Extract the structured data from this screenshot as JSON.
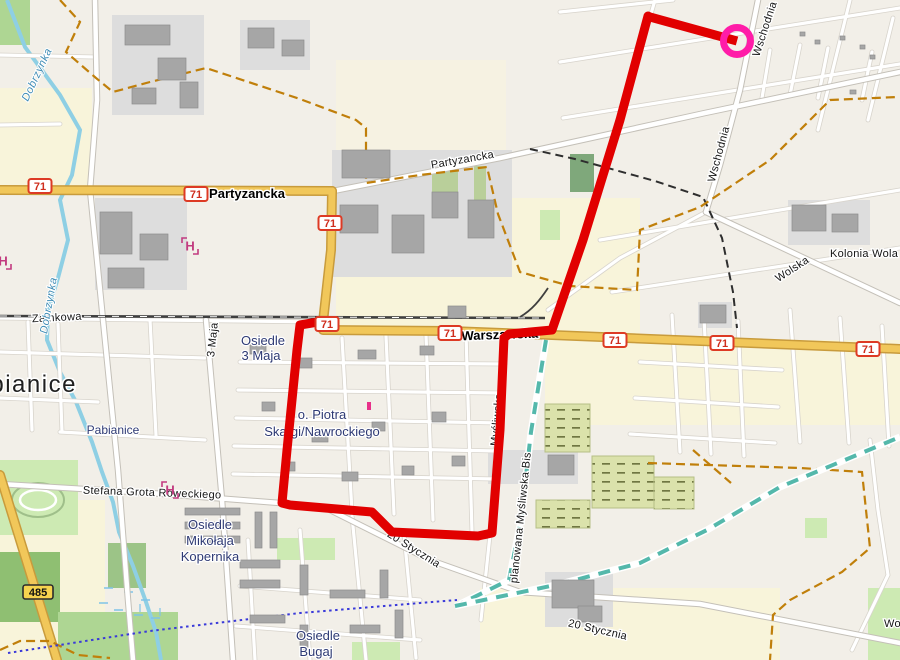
{
  "map": {
    "city_label": {
      "text": "Pabianice",
      "x": -42,
      "y": 392
    },
    "route": {
      "color": "#e10000",
      "width": 9,
      "points": [
        [
          737,
          41
        ],
        [
          650,
          17
        ],
        [
          648,
          16
        ],
        [
          620,
          120
        ],
        [
          583,
          240
        ],
        [
          552,
          330
        ],
        [
          509,
          334
        ],
        [
          504,
          338
        ],
        [
          500,
          430
        ],
        [
          492,
          533
        ],
        [
          478,
          536
        ],
        [
          392,
          532
        ],
        [
          372,
          512
        ],
        [
          290,
          505
        ],
        [
          282,
          503
        ],
        [
          287,
          450
        ],
        [
          297,
          350
        ],
        [
          300,
          325
        ],
        [
          318,
          322
        ]
      ]
    },
    "marker": {
      "x": 737,
      "y": 41,
      "radius": 13.5,
      "ring_color": "#ff1ca8",
      "ring_width": 7
    },
    "shields": [
      {
        "label": "71",
        "style": "national",
        "x": 40,
        "y": 186
      },
      {
        "label": "71",
        "style": "national",
        "x": 196,
        "y": 194
      },
      {
        "label": "71",
        "style": "national",
        "x": 330,
        "y": 223
      },
      {
        "label": "71",
        "style": "national",
        "x": 327,
        "y": 324
      },
      {
        "label": "71",
        "style": "national",
        "x": 450,
        "y": 333
      },
      {
        "label": "71",
        "style": "national",
        "x": 615,
        "y": 340
      },
      {
        "label": "71",
        "style": "national",
        "x": 722,
        "y": 343
      },
      {
        "label": "71",
        "style": "national",
        "x": 868,
        "y": 349
      },
      {
        "label": "485",
        "style": "regional",
        "x": 38,
        "y": 592
      }
    ],
    "street_labels": [
      {
        "t": "Zamkowa",
        "x": 57,
        "y": 321,
        "r": -3,
        "cls": "lbl-road"
      },
      {
        "t": "Partyzancka",
        "x": 247,
        "y": 198,
        "r": 0,
        "cls": "lbl-road-bold"
      },
      {
        "t": "Partyzancka",
        "x": 463,
        "y": 163,
        "r": -10,
        "cls": "lbl-road"
      },
      {
        "t": "Warszawska",
        "x": 500,
        "y": 339,
        "r": -2,
        "cls": "lbl-road-bold"
      },
      {
        "t": "Wschodnia",
        "x": 722,
        "y": 155,
        "r": -75,
        "cls": "lbl-road"
      },
      {
        "t": "Wschodnia",
        "x": 768,
        "y": 30,
        "r": -72,
        "cls": "lbl-road"
      },
      {
        "t": "Wolska",
        "x": 794,
        "y": 272,
        "r": -33,
        "cls": "lbl-road"
      },
      {
        "t": "Kolonia Wola",
        "x": 830,
        "y": 257,
        "r": 0,
        "cls": "lbl-road",
        "anchor": "start"
      },
      {
        "t": "3 Maja",
        "x": 216,
        "y": 340,
        "r": -84,
        "cls": "lbl-road"
      },
      {
        "t": "20 Stycznia",
        "x": 412,
        "y": 552,
        "r": 32,
        "cls": "lbl-road"
      },
      {
        "t": "20 Stycznia",
        "x": 597,
        "y": 633,
        "r": 13,
        "cls": "lbl-road"
      },
      {
        "t": "planowana Myśliwska Bis",
        "x": 524,
        "y": 518,
        "r": -84,
        "cls": "lbl-road"
      },
      {
        "t": "Myśliwska",
        "x": 500,
        "y": 420,
        "r": -85,
        "cls": "lbl-road"
      },
      {
        "t": "Stefana Grota Roweckiego",
        "x": 152,
        "y": 496,
        "r": 2,
        "cls": "lbl-road"
      },
      {
        "t": "Wola",
        "x": 884,
        "y": 627,
        "r": 0,
        "cls": "lbl-road",
        "anchor": "start"
      }
    ],
    "water_labels": [
      {
        "t": "Dobrzynka",
        "x": 40,
        "y": 76,
        "r": -65
      },
      {
        "t": "Dobrzynka",
        "x": 52,
        "y": 306,
        "r": -80
      }
    ],
    "place_labels": [
      {
        "t": "Osiedle",
        "x": 263,
        "y": 345,
        "cls": "lbl-place"
      },
      {
        "t": "3 Maja",
        "x": 261,
        "y": 360,
        "cls": "lbl-place"
      },
      {
        "t": "o. Piotra",
        "x": 322,
        "y": 419,
        "cls": "lbl-place"
      },
      {
        "t": "Skargi/Nawrockiego",
        "x": 322,
        "y": 436,
        "cls": "lbl-place"
      },
      {
        "t": "Pabianice",
        "x": 113,
        "y": 434,
        "cls": "lbl-place-sm"
      },
      {
        "t": "Osiedle",
        "x": 210,
        "y": 529,
        "cls": "lbl-place"
      },
      {
        "t": "Mikołaja",
        "x": 210,
        "y": 545,
        "cls": "lbl-place"
      },
      {
        "t": "Kopernika",
        "x": 210,
        "y": 561,
        "cls": "lbl-place"
      },
      {
        "t": "Osiedle",
        "x": 318,
        "y": 640,
        "cls": "lbl-place"
      },
      {
        "t": "Bugaj",
        "x": 316,
        "y": 656,
        "cls": "lbl-place"
      }
    ],
    "hospital_icons": [
      {
        "x": 190,
        "y": 246
      },
      {
        "x": 170,
        "y": 490
      },
      {
        "x": 3,
        "y": 261
      }
    ],
    "poi_markers": [
      {
        "x": 367,
        "y": 402,
        "color": "#e8308a"
      }
    ]
  }
}
